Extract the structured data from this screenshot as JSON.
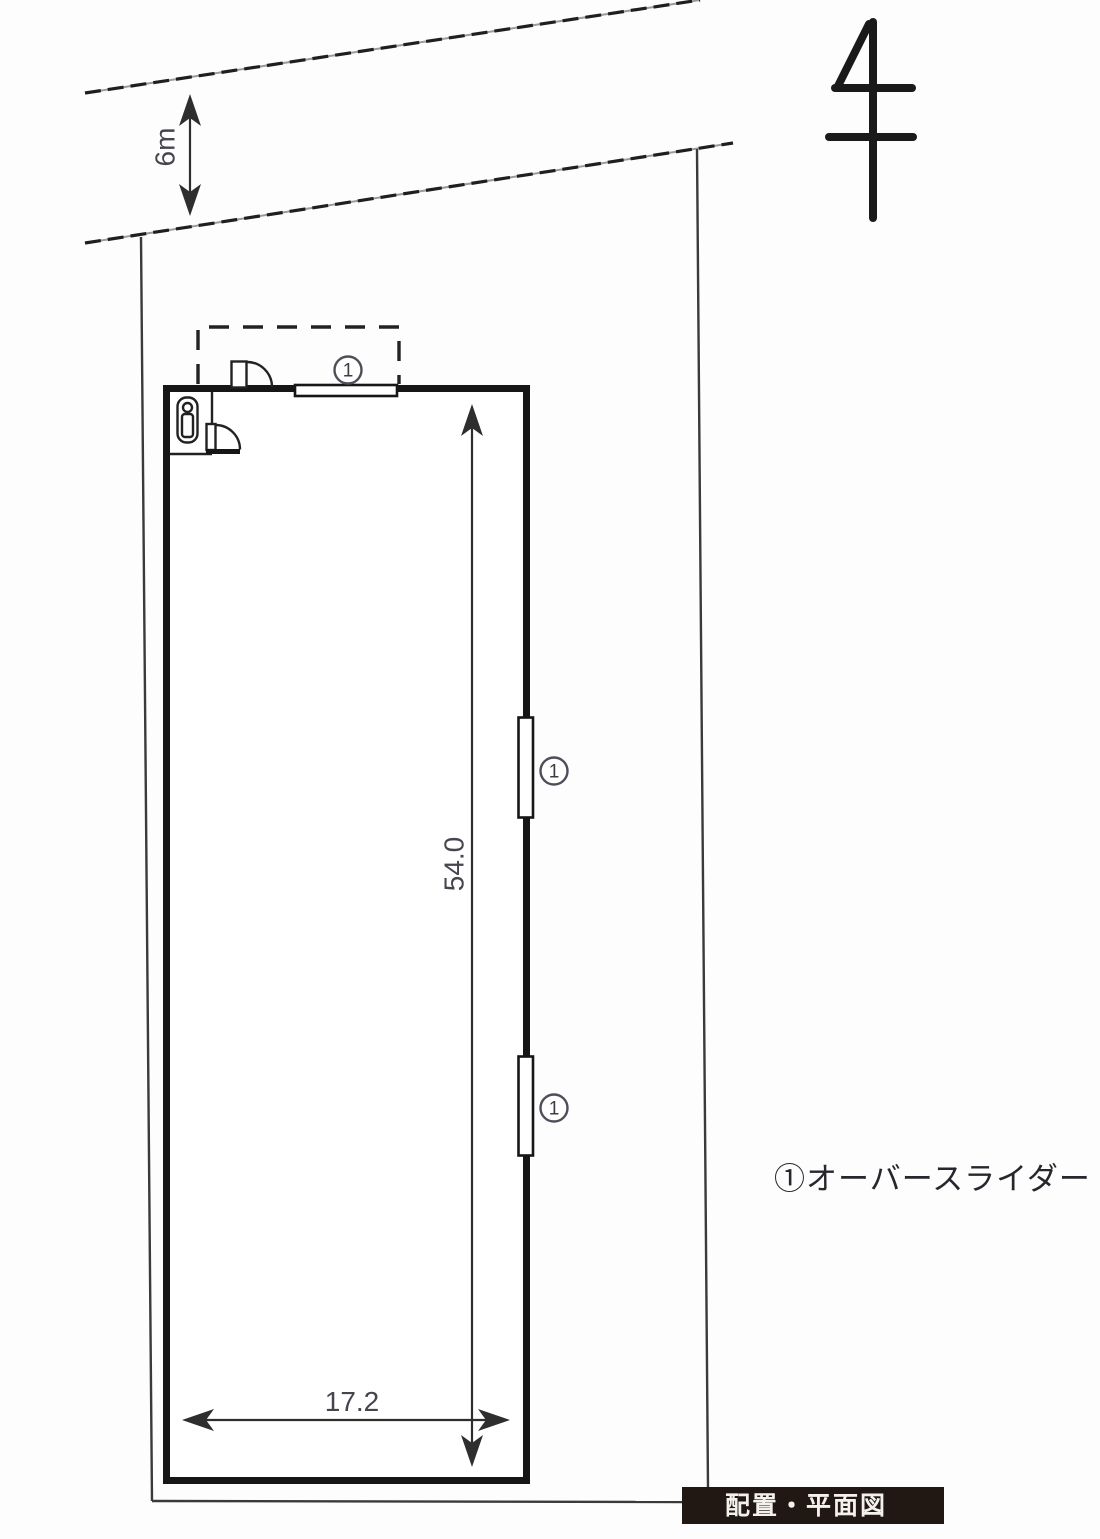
{
  "drawing": {
    "road": {
      "width_label": "6m"
    },
    "dimensions": {
      "building_height": "54.0",
      "building_width": "17.2"
    },
    "openings": [
      {
        "marker": "1"
      },
      {
        "marker": "1"
      },
      {
        "marker": "1"
      }
    ],
    "legend": {
      "item1": "①オーバースライダー"
    },
    "title_badge": "配置・平面図",
    "icons": {
      "north": "north-direction-symbol",
      "door": "door-swing-icon",
      "fixture": "toilet-icon"
    },
    "colors": {
      "line": "#2e2e2e",
      "wall": "#161616",
      "dim_text": "#45454e",
      "badge_bg": "#221813",
      "badge_text": "#f4f1ec"
    }
  }
}
